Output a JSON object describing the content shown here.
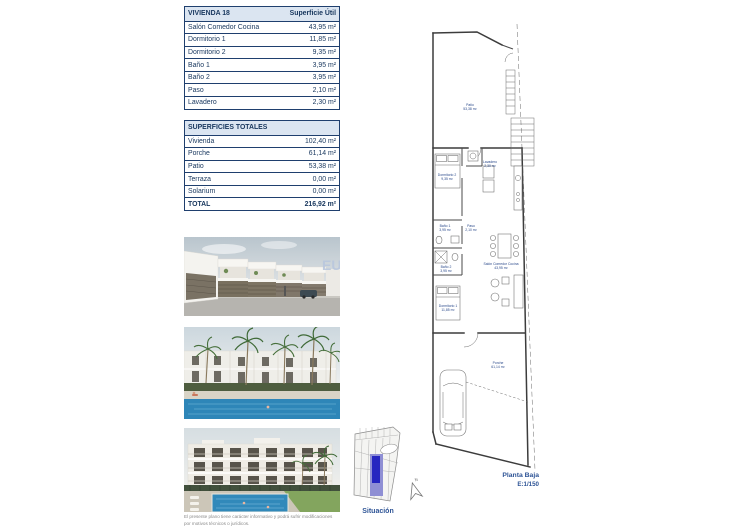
{
  "tables": {
    "vivienda": {
      "header": {
        "title": "VIVIENDA 18",
        "value_label": "Superficie Útil"
      },
      "rows": [
        {
          "label": "Salón Comedor Cocina",
          "value": "43,95 m²"
        },
        {
          "label": "Dormitorio 1",
          "value": "11,85 m²"
        },
        {
          "label": "Dormitorio 2",
          "value": "9,35 m²"
        },
        {
          "label": "Baño 1",
          "value": "3,95 m²"
        },
        {
          "label": "Baño 2",
          "value": "3,95 m²"
        },
        {
          "label": "Paso",
          "value": "2,10 m²"
        },
        {
          "label": "Lavadero",
          "value": "2,30 m²"
        }
      ]
    },
    "totales": {
      "header": {
        "title": "SUPERFICIES TOTALES"
      },
      "rows": [
        {
          "label": "Vivienda",
          "value": "102,40 m²"
        },
        {
          "label": "Porche",
          "value": "61,14 m²"
        },
        {
          "label": "Patio",
          "value": "53,38 m²"
        },
        {
          "label": "Terraza",
          "value": "0,00 m²"
        },
        {
          "label": "Solarium",
          "value": "0,00 m²"
        }
      ],
      "total": {
        "label": "TOTAL",
        "value": "216,92 m²"
      }
    }
  },
  "plan": {
    "title": "Planta Baja",
    "scale": "E:1/150",
    "north": "N",
    "rooms": {
      "patio": {
        "name": "Patio",
        "area": "53,38 m²"
      },
      "lavadero": {
        "name": "Lavadero",
        "area": "2,30 m²"
      },
      "dormitorio2": {
        "name": "Dormitorio 2",
        "area": "9,35 m²"
      },
      "bano1": {
        "name": "Baño 1",
        "area": "3,95 m²"
      },
      "paso": {
        "name": "Paso",
        "area": "2,10 m²"
      },
      "bano2": {
        "name": "Baño 2",
        "area": "3,95 m²"
      },
      "dormitorio1": {
        "name": "Dormitorio 1",
        "area": "11,85 m²"
      },
      "salon": {
        "name": "Salón Comedor Cocina",
        "area": "43,95 m²"
      },
      "porche": {
        "name": "Porche",
        "area": "61,14 m²"
      }
    }
  },
  "situacion": {
    "label": "Situación"
  },
  "renders": {
    "watermark": "EU"
  },
  "disclaimer": {
    "text": "El presente plano tiene carácter informativo y podrá sufrir modificaciones por motivos técnicos o jurídicos."
  },
  "colors": {
    "table_text": "#17365d",
    "table_border": "#1f3f6e",
    "table_header_bg": "#dbe5f1",
    "plan_label_blue": "#2b4a8b",
    "plan_title_blue": "#2e5496",
    "situacion_highlight_dark": "#2626c0",
    "situacion_highlight_light": "#8f8fd4",
    "pool_blue": "#2e86b8",
    "watermark_blue": "#b9c7de"
  }
}
